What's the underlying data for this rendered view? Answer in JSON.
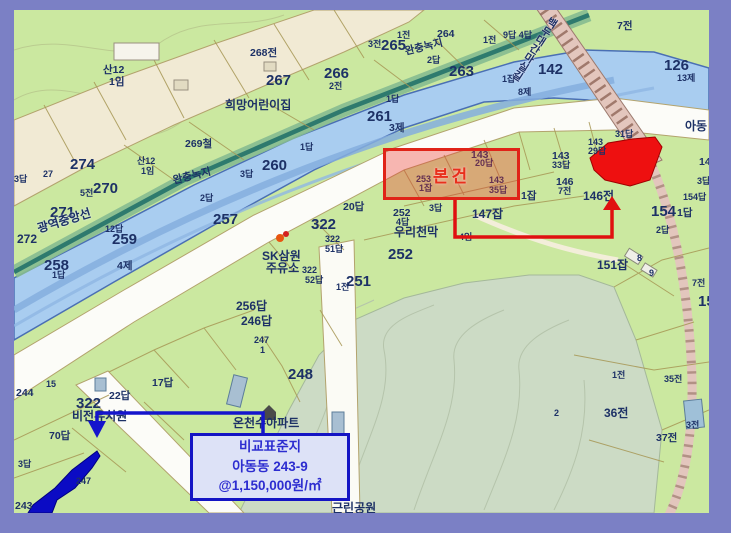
{
  "frame": {
    "border_color": "#7b80c5"
  },
  "annotations": {
    "subject": {
      "label": "본건",
      "box_color": "#e02318"
    },
    "comparison": {
      "lines": [
        "비교표준지",
        "아동동 243-9",
        "@1,150,000원/㎡"
      ],
      "box_color": "#1414c4"
    }
  },
  "colors": {
    "field_green": "#cbe8a0",
    "park_sage": "#ccdbc5",
    "river_blue": "#a9cdf0",
    "road_white": "#fcfcf8",
    "residential_beige": "#f1ead4",
    "greenway_teal": "#2e7a6e",
    "railway_pink": "#e3c6bd",
    "parcel_line": "#a79755",
    "label_navy": "#1d3166",
    "highlight_red": "#ee1010",
    "highlight_blue": "#0b0bc4"
  },
  "labels": [
    {
      "t": "산12",
      "x": 89,
      "y": 55,
      "s": "md"
    },
    {
      "t": "1임",
      "x": 95,
      "y": 67,
      "s": "md"
    },
    {
      "t": "268전",
      "x": 236,
      "y": 38,
      "s": "md"
    },
    {
      "t": "267",
      "x": 252,
      "y": 63,
      "s": "xl"
    },
    {
      "t": "희망어린이집",
      "x": 211,
      "y": 89,
      "s": "lg",
      "c": "dark"
    },
    {
      "t": "269철",
      "x": 171,
      "y": 129,
      "s": "md"
    },
    {
      "t": "274",
      "x": 56,
      "y": 147,
      "s": "xl"
    },
    {
      "t": "270",
      "x": 79,
      "y": 171,
      "s": "xl"
    },
    {
      "t": "5전",
      "x": 66,
      "y": 179,
      "s": "sm"
    },
    {
      "t": "산12",
      "x": 123,
      "y": 147,
      "s": "sm"
    },
    {
      "t": "1임",
      "x": 127,
      "y": 157,
      "s": "sm"
    },
    {
      "t": "완충녹지",
      "x": 158,
      "y": 166,
      "s": "md",
      "c": "olive",
      "r": -14
    },
    {
      "t": "2답",
      "x": 186,
      "y": 184,
      "s": "sm"
    },
    {
      "t": "257",
      "x": 199,
      "y": 202,
      "s": "xl"
    },
    {
      "t": "271",
      "x": 36,
      "y": 195,
      "s": "xl"
    },
    {
      "t": "27",
      "x": 29,
      "y": 160,
      "s": "sm"
    },
    {
      "t": "3답",
      "x": 0,
      "y": 165,
      "s": "sm"
    },
    {
      "t": "272",
      "x": 3,
      "y": 223,
      "s": "lg"
    },
    {
      "t": "광역중앙선",
      "x": 22,
      "y": 213,
      "s": "lg",
      "c": "blue",
      "r": -17
    },
    {
      "t": "12답",
      "x": 91,
      "y": 215,
      "s": "sm"
    },
    {
      "t": "259",
      "x": 98,
      "y": 222,
      "s": "xl"
    },
    {
      "t": "4제",
      "x": 103,
      "y": 251,
      "s": "md"
    },
    {
      "t": "258",
      "x": 30,
      "y": 248,
      "s": "xl"
    },
    {
      "t": "1답",
      "x": 38,
      "y": 261,
      "s": "sm"
    },
    {
      "t": "1답",
      "x": 286,
      "y": 133,
      "s": "sm"
    },
    {
      "t": "260",
      "x": 248,
      "y": 148,
      "s": "xl"
    },
    {
      "t": "3답",
      "x": 226,
      "y": 160,
      "s": "sm"
    },
    {
      "t": "3전",
      "x": 354,
      "y": 30,
      "s": "sm"
    },
    {
      "t": "265",
      "x": 367,
      "y": 28,
      "s": "xl"
    },
    {
      "t": "1전",
      "x": 383,
      "y": 21,
      "s": "sm"
    },
    {
      "t": "2답",
      "x": 413,
      "y": 46,
      "s": "sm"
    },
    {
      "t": "266",
      "x": 310,
      "y": 56,
      "s": "xl"
    },
    {
      "t": "2전",
      "x": 315,
      "y": 72,
      "s": "sm"
    },
    {
      "t": "264",
      "x": 423,
      "y": 19,
      "s": "md"
    },
    {
      "t": "263",
      "x": 435,
      "y": 54,
      "s": "xl"
    },
    {
      "t": "1전",
      "x": 469,
      "y": 26,
      "s": "sm"
    },
    {
      "t": "완충녹지",
      "x": 390,
      "y": 37,
      "s": "md",
      "c": "olive",
      "r": -14
    },
    {
      "t": "261",
      "x": 353,
      "y": 99,
      "s": "xl"
    },
    {
      "t": "1답",
      "x": 372,
      "y": 85,
      "s": "sm"
    },
    {
      "t": "3제",
      "x": 375,
      "y": 113,
      "s": "md"
    },
    {
      "t": "9답 4답",
      "x": 489,
      "y": 21,
      "s": "sm"
    },
    {
      "t": "7전",
      "x": 603,
      "y": 11,
      "s": "md"
    },
    {
      "t": "142",
      "x": 524,
      "y": 52,
      "s": "xl"
    },
    {
      "t": "126",
      "x": 650,
      "y": 48,
      "s": "xl"
    },
    {
      "t": "13제",
      "x": 663,
      "y": 64,
      "s": "sm"
    },
    {
      "t": "8제",
      "x": 504,
      "y": 78,
      "s": "sm"
    },
    {
      "t": "1잡",
      "x": 488,
      "y": 65,
      "s": "sm"
    },
    {
      "t": "아동",
      "x": 671,
      "y": 110,
      "s": "lg",
      "c": "dark"
    },
    {
      "t": "백두대간마실길",
      "x": 536,
      "y": 5,
      "s": "md",
      "c": "purple",
      "vert": true,
      "r": 33
    },
    {
      "t": "20답",
      "x": 329,
      "y": 192,
      "s": "md"
    },
    {
      "t": "322",
      "x": 297,
      "y": 207,
      "s": "xl"
    },
    {
      "t": "322",
      "x": 311,
      "y": 225,
      "s": "sm"
    },
    {
      "t": "51답",
      "x": 311,
      "y": 235,
      "s": "sm"
    },
    {
      "t": "SK삼원",
      "x": 248,
      "y": 240,
      "s": "lg",
      "c": "dark"
    },
    {
      "t": "주유소",
      "x": 252,
      "y": 252,
      "s": "lg",
      "c": "dark"
    },
    {
      "t": "252",
      "x": 379,
      "y": 198,
      "s": "md"
    },
    {
      "t": "4답",
      "x": 382,
      "y": 208,
      "s": "sm"
    },
    {
      "t": "우리천막",
      "x": 380,
      "y": 216,
      "s": "lg",
      "c": "dark"
    },
    {
      "t": "4임",
      "x": 445,
      "y": 223,
      "s": "sm"
    },
    {
      "t": "3답",
      "x": 415,
      "y": 194,
      "s": "sm"
    },
    {
      "t": "147잡",
      "x": 458,
      "y": 198,
      "s": "lg"
    },
    {
      "t": "252",
      "x": 374,
      "y": 237,
      "s": "xl"
    },
    {
      "t": "251",
      "x": 332,
      "y": 264,
      "s": "xl"
    },
    {
      "t": "1전",
      "x": 322,
      "y": 273,
      "s": "sm"
    },
    {
      "t": "322",
      "x": 288,
      "y": 256,
      "s": "sm"
    },
    {
      "t": "52답",
      "x": 291,
      "y": 266,
      "s": "sm"
    },
    {
      "t": "256답",
      "x": 222,
      "y": 290,
      "s": "lg"
    },
    {
      "t": "246답",
      "x": 227,
      "y": 305,
      "s": "lg"
    },
    {
      "t": "143",
      "x": 457,
      "y": 140,
      "s": "md"
    },
    {
      "t": "20답",
      "x": 461,
      "y": 149,
      "s": "sm"
    },
    {
      "t": "253",
      "x": 402,
      "y": 165,
      "s": "sm"
    },
    {
      "t": "1잡",
      "x": 405,
      "y": 174,
      "s": "sm"
    },
    {
      "t": "143",
      "x": 475,
      "y": 166,
      "s": "sm"
    },
    {
      "t": "35답",
      "x": 475,
      "y": 176,
      "s": "sm"
    },
    {
      "t": "143",
      "x": 538,
      "y": 141,
      "s": "md"
    },
    {
      "t": "33답",
      "x": 538,
      "y": 151,
      "s": "sm"
    },
    {
      "t": "146",
      "x": 542,
      "y": 167,
      "s": "md"
    },
    {
      "t": "7전",
      "x": 544,
      "y": 177,
      "s": "sm"
    },
    {
      "t": "1잡",
      "x": 507,
      "y": 181,
      "s": "md"
    },
    {
      "t": "146전",
      "x": 569,
      "y": 180,
      "s": "lg"
    },
    {
      "t": "143",
      "x": 574,
      "y": 128,
      "s": "sm"
    },
    {
      "t": "29답",
      "x": 574,
      "y": 137,
      "s": "sm"
    },
    {
      "t": "31답",
      "x": 601,
      "y": 120,
      "s": "sm"
    },
    {
      "t": "147",
      "x": 685,
      "y": 147,
      "s": "md"
    },
    {
      "t": "3답",
      "x": 683,
      "y": 167,
      "s": "sm"
    },
    {
      "t": "154답",
      "x": 669,
      "y": 183,
      "s": "sm"
    },
    {
      "t": "154",
      "x": 637,
      "y": 194,
      "s": "xl"
    },
    {
      "t": "1답",
      "x": 663,
      "y": 198,
      "s": "md"
    },
    {
      "t": "2답",
      "x": 642,
      "y": 216,
      "s": "sm"
    },
    {
      "t": "151잡",
      "x": 583,
      "y": 249,
      "s": "lg"
    },
    {
      "t": "8",
      "x": 623,
      "y": 244,
      "s": "sm"
    },
    {
      "t": "9",
      "x": 635,
      "y": 259,
      "s": "sm"
    },
    {
      "t": "7전",
      "x": 678,
      "y": 269,
      "s": "sm"
    },
    {
      "t": "154",
      "x": 684,
      "y": 284,
      "s": "xl"
    },
    {
      "t": "1전",
      "x": 598,
      "y": 361,
      "s": "sm"
    },
    {
      "t": "35전",
      "x": 650,
      "y": 365,
      "s": "sm"
    },
    {
      "t": "36전",
      "x": 590,
      "y": 397,
      "s": "lg"
    },
    {
      "t": "37전",
      "x": 642,
      "y": 423,
      "s": "md"
    },
    {
      "t": "3전",
      "x": 672,
      "y": 411,
      "s": "sm"
    },
    {
      "t": "2",
      "x": 540,
      "y": 399,
      "s": "sm"
    },
    {
      "t": "248",
      "x": 274,
      "y": 357,
      "s": "xl"
    },
    {
      "t": "247",
      "x": 240,
      "y": 326,
      "s": "sm"
    },
    {
      "t": "1",
      "x": 246,
      "y": 336,
      "s": "sm"
    },
    {
      "t": "322",
      "x": 62,
      "y": 386,
      "s": "xl"
    },
    {
      "t": "비전유치원",
      "x": 58,
      "y": 400,
      "s": "lg",
      "c": "dark"
    },
    {
      "t": "70답",
      "x": 35,
      "y": 421,
      "s": "md"
    },
    {
      "t": "22답",
      "x": 95,
      "y": 381,
      "s": "md"
    },
    {
      "t": "17답",
      "x": 138,
      "y": 368,
      "s": "md"
    },
    {
      "t": "15",
      "x": 32,
      "y": 370,
      "s": "sm"
    },
    {
      "t": "244",
      "x": 2,
      "y": 378,
      "s": "md"
    },
    {
      "t": "3답",
      "x": 4,
      "y": 450,
      "s": "sm"
    },
    {
      "t": "243",
      "x": 1,
      "y": 491,
      "s": "md"
    },
    {
      "t": "247",
      "x": 62,
      "y": 467,
      "s": "sm"
    },
    {
      "t": "근린공원",
      "x": 318,
      "y": 492,
      "s": "lg",
      "c": "olive2"
    },
    {
      "t": "온천수아파트",
      "x": 219,
      "y": 407,
      "s": "lg",
      "c": "dark"
    }
  ]
}
